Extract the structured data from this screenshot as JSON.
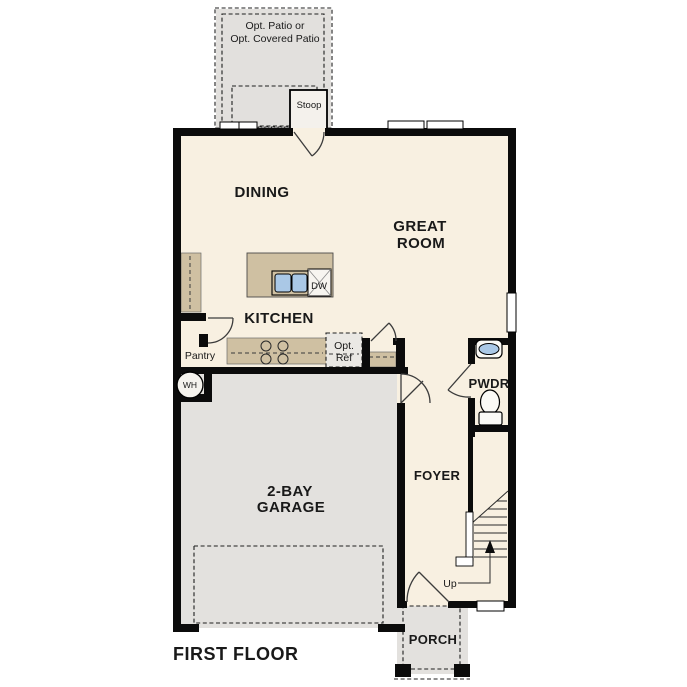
{
  "plan_title": "FIRST FLOOR",
  "colors": {
    "wall": "#0b0b0b",
    "floor": "#f8f0e1",
    "garage_floor": "#e3e1de",
    "patio_floor": "#e2e0dd",
    "porch_floor": "#e3e1de",
    "counter": "#cfc0a2",
    "sink_blue": "#aac8e6",
    "optional_fill": "#eae8e4",
    "fixture_white": "#fbfaf6"
  },
  "rooms": {
    "dining": "DINING",
    "great_room": [
      "GREAT",
      "ROOM"
    ],
    "kitchen": "KITCHEN",
    "garage": [
      "2-BAY",
      "GARAGE"
    ],
    "foyer": "FOYER",
    "powder": "PWDR",
    "porch": "PORCH",
    "pantry": "Pantry",
    "stoop": "Stoop"
  },
  "features": {
    "opt_patio": [
      "Opt. Patio or",
      "Opt. Covered Patio"
    ],
    "opt_ref": [
      "Opt.",
      "Ref"
    ],
    "water_heater": "WH",
    "dishwasher": "DW",
    "stairs_up": "Up"
  }
}
